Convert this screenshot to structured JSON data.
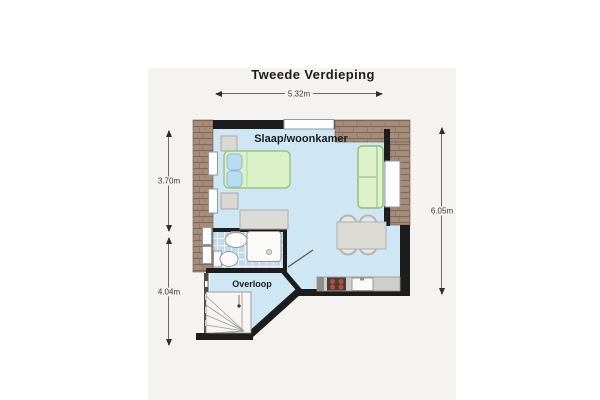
{
  "title": "Tweede Verdieping",
  "rooms": {
    "main": "Slaap/woonkamer",
    "landing": "Overloop"
  },
  "dimensions": {
    "top_width": "5.32m",
    "left_upper_height": "3.70m",
    "left_lower_height": "4.04m",
    "right_height": "6.05m"
  },
  "colors": {
    "page_background": "#ffffff",
    "card_background": "#f4f3f1",
    "floor_blue": "#cfe7f5",
    "bathroom_tile": "#bfdbed",
    "wall_brick": "#a68c7b",
    "wall_black": "#1d1d1d",
    "furniture_green": "#daf0c6",
    "pillow_blue": "#b9dcf0",
    "furniture_gray": "#dcdbd6",
    "burner_red": "#a85443"
  }
}
